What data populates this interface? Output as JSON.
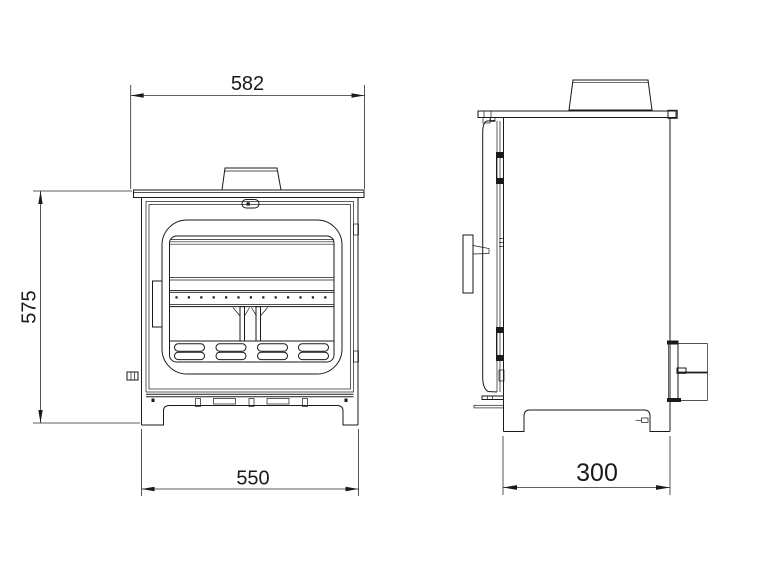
{
  "drawing": {
    "views": {
      "front_label": "front-view",
      "side_label": "side-view"
    },
    "dimensions": {
      "overall_width": "582",
      "overall_height": "575",
      "base_width": "550",
      "base_depth": "300"
    },
    "colors": {
      "background": "#ffffff",
      "object_line": "#1a1a1a",
      "dimension_line": "#2a2a2a"
    }
  }
}
